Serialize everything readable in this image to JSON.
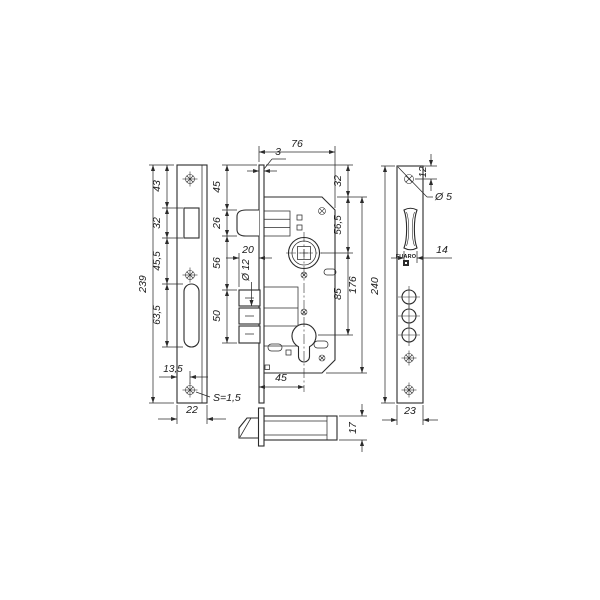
{
  "drawing": {
    "brand": "FUARO",
    "colors": {
      "line": "#2b2b2b",
      "background": "#ffffff"
    },
    "labels": {
      "faceplate": {
        "overall_height": "239",
        "top_to_latch": "43",
        "latch_cutout": "32",
        "latch_to_bolt": "45,5",
        "bolt_cutout": "63,5",
        "screw_offset": "13,5",
        "width": "22",
        "steel_note": "S=1,5"
      },
      "body": {
        "depth": "76",
        "plate_thickness": "3",
        "top_to_latch": "45",
        "latch_height": "26",
        "latch_to_bolt": "56",
        "bolt_height": "50",
        "bolt_throw": "20",
        "bolt_hole": "Ø 12",
        "backset": "45",
        "plate_overhang": "32",
        "top_to_follower": "56,5",
        "follower_to_cylinder": "85",
        "case_height": "176"
      },
      "strike": {
        "top_screw_offset": "12",
        "screw_hole": "Ø 5",
        "roller_width": "14",
        "height": "240",
        "width": "23"
      },
      "latch_side": {
        "bolt_height": "17"
      }
    }
  }
}
